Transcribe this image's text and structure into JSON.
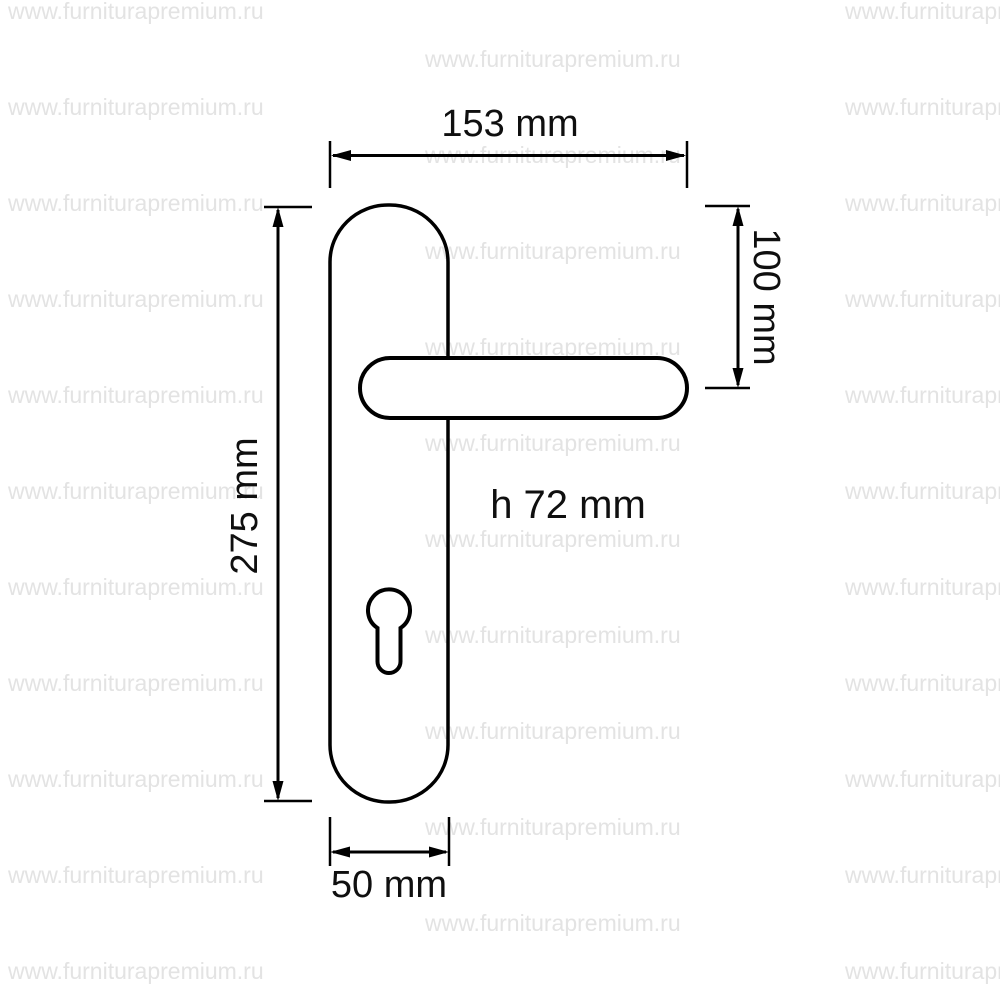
{
  "watermark": {
    "text": "www.furniturapremium.ru",
    "color": "#e3e3e3"
  },
  "drawing": {
    "line_color": "#000000",
    "subject": "door-handle-on-backplate",
    "dimensions": {
      "total_length": {
        "label": "153 mm"
      },
      "handle_offset": {
        "label": "100 mm"
      },
      "plate_height": {
        "label": "275 mm"
      },
      "plate_width": {
        "label": "50 mm"
      },
      "handle_height": {
        "label": "h 72 mm"
      }
    }
  }
}
